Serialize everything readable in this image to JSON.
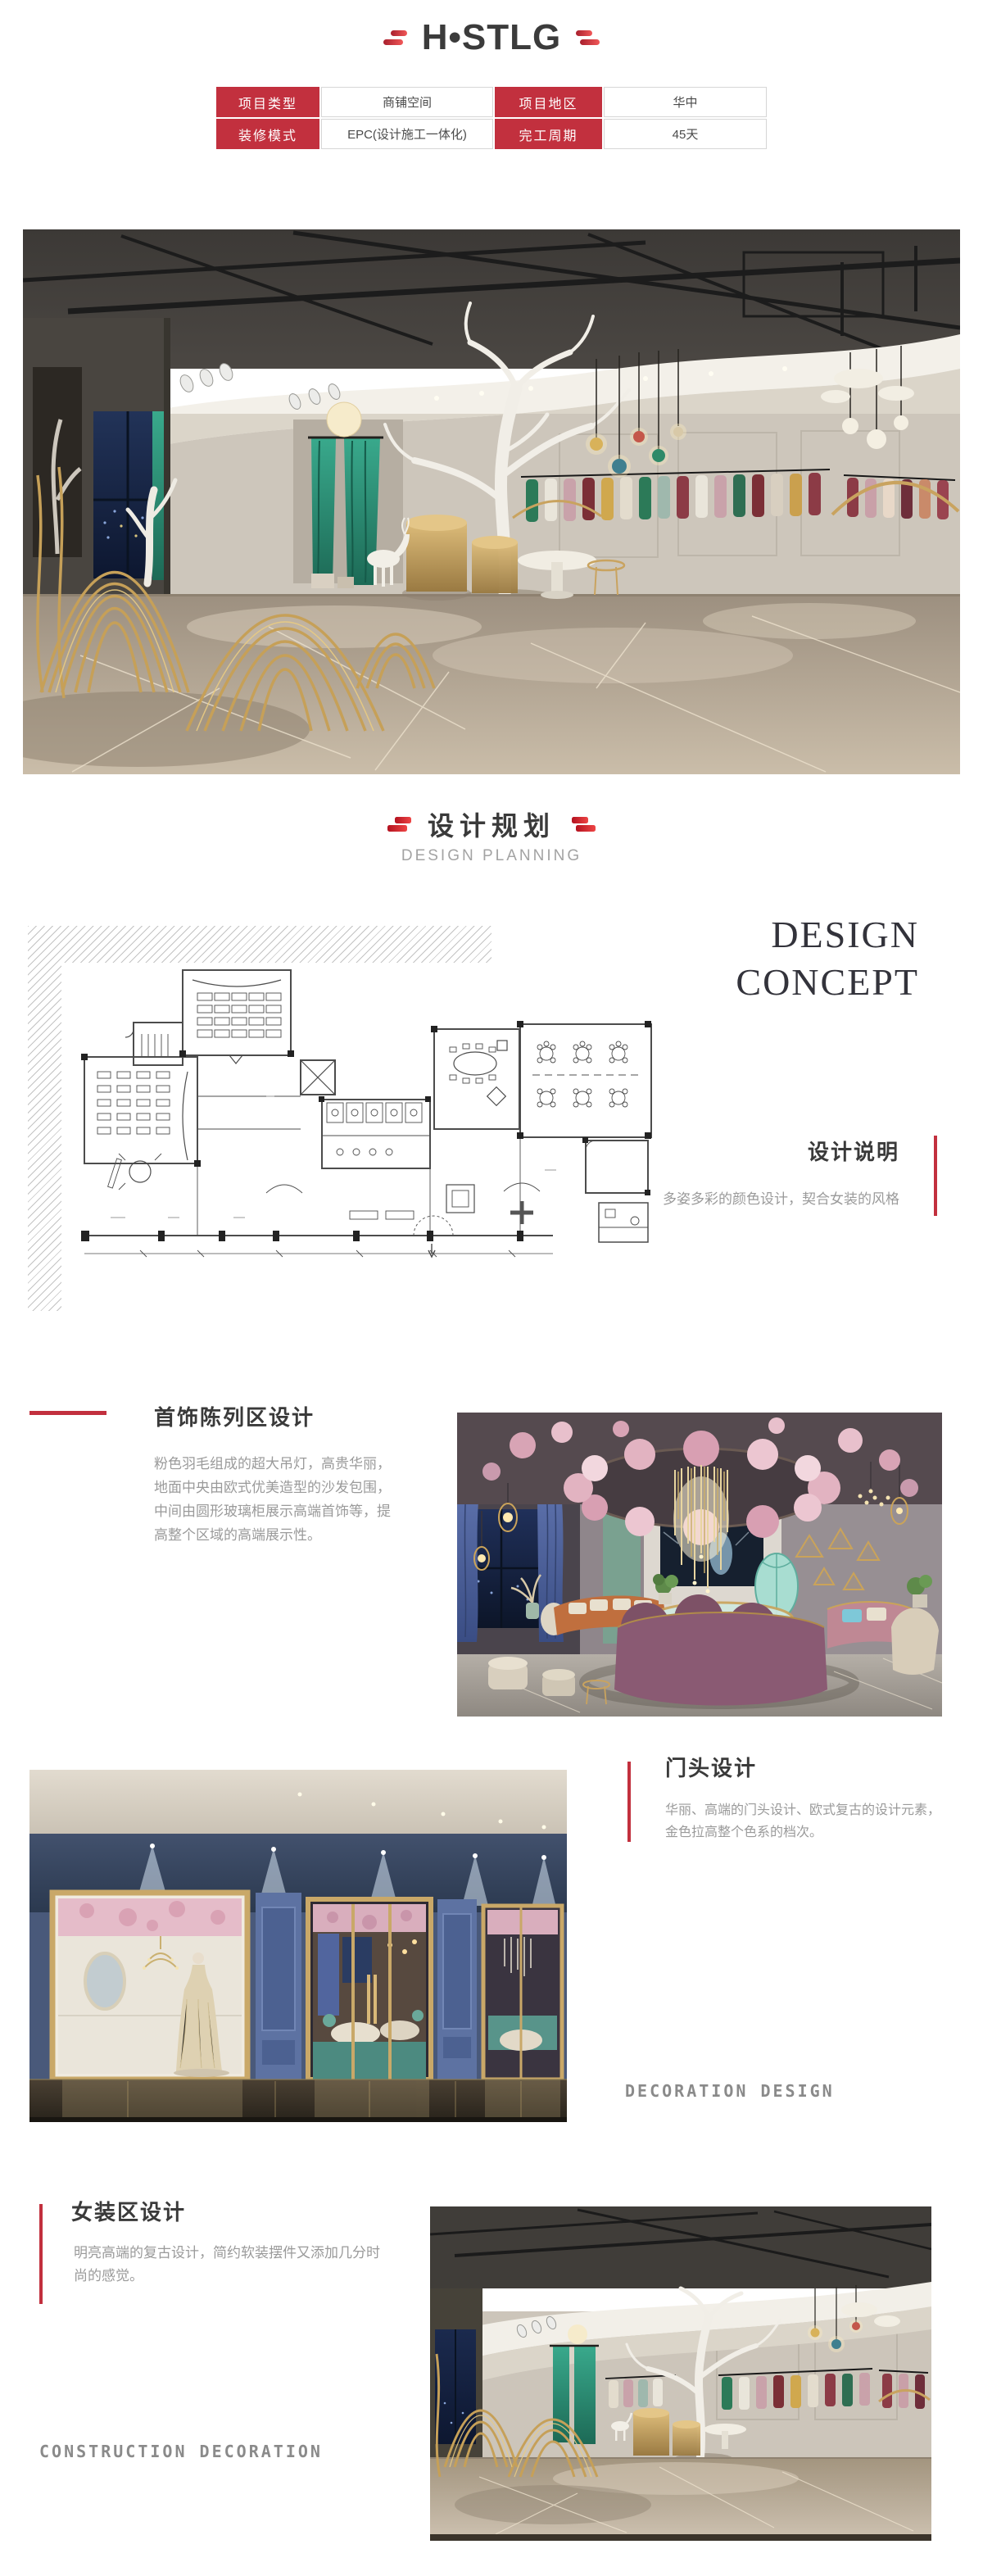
{
  "brand": {
    "logo_text": "H•STLG"
  },
  "info_table": {
    "rows": [
      {
        "cells": [
          "项目类型",
          "商铺空间",
          "项目地区",
          "华中"
        ]
      },
      {
        "cells": [
          "装修模式",
          "EPC(设计施工一体化)",
          "完工周期",
          "45天"
        ]
      }
    ]
  },
  "planning": {
    "title": "设计规划",
    "subtitle": "DESIGN PLANNING"
  },
  "concept": {
    "heading_line1": "DESIGN",
    "heading_line2": "CONCEPT",
    "note_title": "设计说明",
    "note_body": "多姿多彩的颜色设计，契合女装的风格"
  },
  "sections": {
    "jewelry": {
      "title": "首饰陈列区设计",
      "body": "粉色羽毛组成的超大吊灯，高贵华丽，地面中央由欧式优美造型的沙发包围，中间由圆形玻璃柜展示高端首饰等，提高整个区域的高端展示性。"
    },
    "storefront": {
      "title": "门头设计",
      "body": "华丽、高端的门头设计、欧式复古的设计元素，金色拉高整个色系的档次。",
      "caption": "DECORATION DESIGN"
    },
    "womens": {
      "title": "女装区设计",
      "body": "明亮高端的复古设计，简约软装摆件又添加几分时尚的感觉。",
      "caption": "CONSTRUCTION DECORATION"
    }
  },
  "colors": {
    "accent_red": "#c2303e",
    "title_dark": "#3a3a3a",
    "body_gray": "#9a9a9a",
    "caption_gray": "#8a8a8a"
  }
}
